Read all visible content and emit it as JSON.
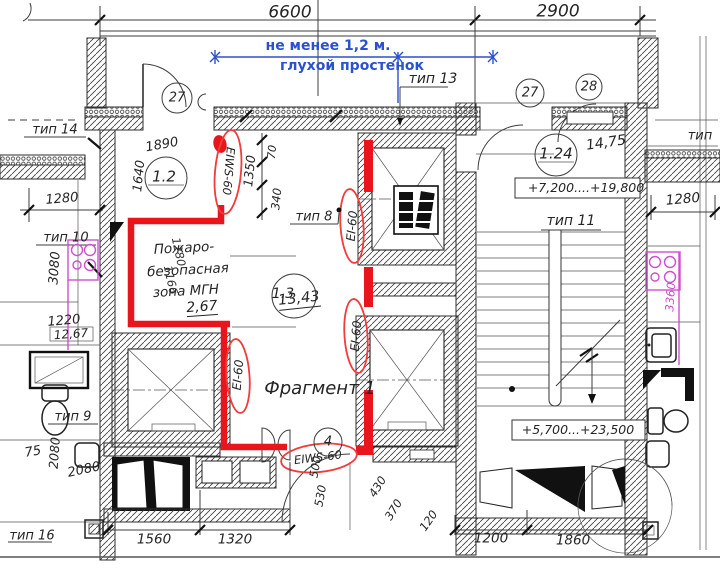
{
  "drawing": {
    "colors": {
      "fire_red": "#e9151d",
      "note_blue": "#2b51cc",
      "fixture_magenta": "#cf4fcf"
    },
    "top_dims": {
      "span_left": "6600",
      "span_right": "2900"
    },
    "blue_note": {
      "line1": "не менее 1,2 м.",
      "line2": "глухой простенок"
    },
    "type_labels": {
      "t14": "тип 14",
      "t13": "тип 13",
      "t10": "тип 10",
      "t9": "тип 9",
      "t16": "тип 16",
      "t8": "тип 8",
      "t11": "тип 11",
      "t_right": "тип"
    },
    "detail_marks": {
      "c27_left": "27",
      "c27_right": "27",
      "c28": "28",
      "c4": "4"
    },
    "room_tags": {
      "left": "1.2",
      "center": "1.3",
      "right": "1.24"
    },
    "areas": {
      "mgn_zone": "2,67",
      "center_room": "13,43",
      "right_room": "14,75",
      "left_room": "12,67"
    },
    "fire_ratings": {
      "door_top": "EIWS-60",
      "wall_upper": "EI-60",
      "wall_lower": "EI-60",
      "corridor": "EI-60",
      "door_bottom": "EIWS-60"
    },
    "mgn_zone": {
      "line1": "Пожаро-",
      "line2": "безопасная",
      "line3": "зона МГН"
    },
    "fragment_label": "Фрагмент 1",
    "elevations": {
      "upper": "+7,200....+19,800",
      "lower": "+5,700...+23,500"
    },
    "dims": {
      "d1890": "1890",
      "d1640": "1640",
      "d1350": "1350",
      "d70": "70",
      "d340": "340",
      "d1280_left": "1280",
      "d3080": "3080",
      "d1220": "1220",
      "d75": "75",
      "d2080_v": "2080",
      "d2080_h": "2080",
      "d1560": "1560",
      "d1320": "1320",
      "d500": "500",
      "d530": "530",
      "d120": "120",
      "d430": "430",
      "d370": "370",
      "d1200": "1200",
      "d1860": "1860",
      "d1280_right": "1280",
      "d3360": "3360",
      "d1280_zone": "1280",
      "d1166": "1166"
    }
  }
}
